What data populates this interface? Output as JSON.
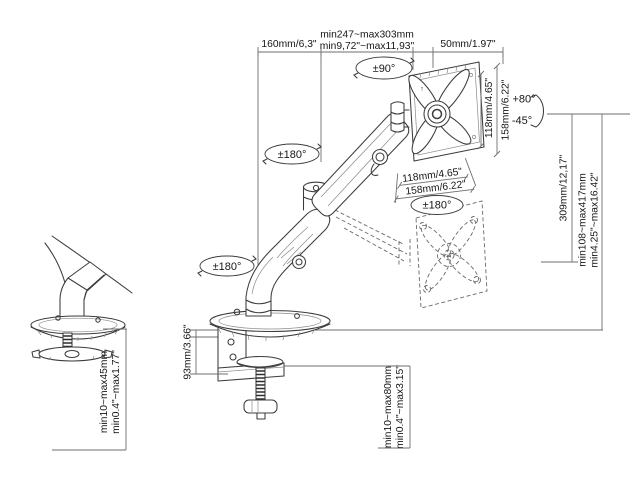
{
  "diagram": {
    "top": {
      "arm_length": "160mm/6,3\"",
      "extension_range_mm": "min247~max303mm",
      "extension_range_in": "min9,72\"~max11,93\"",
      "head_depth": "50mm/1.97\""
    },
    "rotation": {
      "head_swivel": "±90°",
      "upper_joint": "±180°",
      "base_joint": "±180°",
      "vesa_plate": "±180°",
      "tilt_up": "+80°",
      "tilt_down": "-45°"
    },
    "vesa": {
      "size_inner": "118mm/4.65\"",
      "size_outer": "158mm/6.22\"",
      "up_marking": "↑"
    },
    "height": {
      "lift_stroke": "309mm/12,17\"",
      "range_mm": "min108~max417mm",
      "range_in": "min4.25\"~max16.42\""
    },
    "grommet_mount": {
      "desk_thickness_mm": "min10~max45mm",
      "desk_thickness_in": "min0.4\"~max1.77\""
    },
    "clamp_mount": {
      "clamp_height": "93mm/3.66\"",
      "desk_thickness_mm": "min10~max80mm",
      "desk_thickness_in": "min0.4\"~max3.15\""
    }
  },
  "colors": {
    "background": "#ffffff",
    "line": "#3c3c3c",
    "dimension": "#6b6b6b",
    "text": "#111111"
  }
}
